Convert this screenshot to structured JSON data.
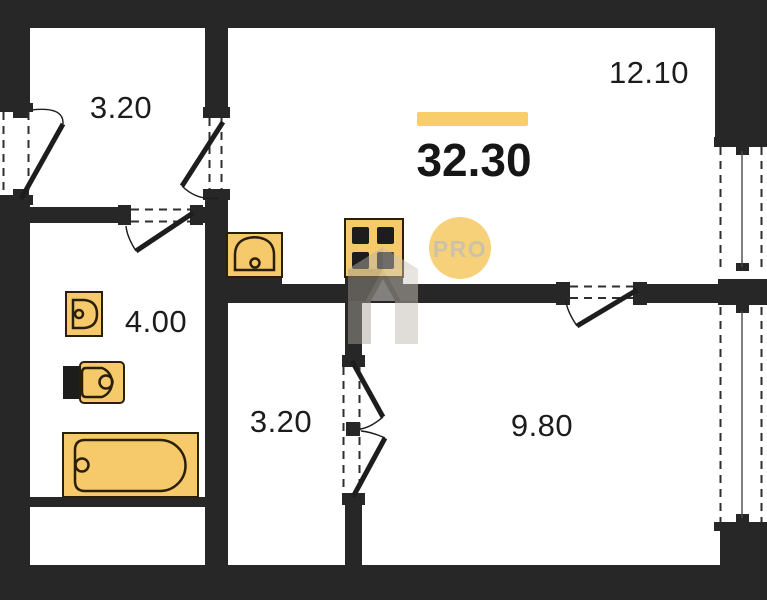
{
  "plan": {
    "title": "apartment-floor-plan",
    "total_area": "32.30",
    "badge_label": "PRO",
    "rooms": [
      {
        "id": "entrance-hall",
        "area": "3.20"
      },
      {
        "id": "living-kitchen",
        "area": "12.10"
      },
      {
        "id": "bathroom",
        "area": "4.00"
      },
      {
        "id": "corridor",
        "area": "3.20"
      },
      {
        "id": "bedroom",
        "area": "9.80"
      }
    ],
    "fixtures": [
      "kitchen-sink",
      "stove",
      "bathroom-sink",
      "toilet",
      "bathtub"
    ],
    "colors": {
      "wall": "#272727",
      "fixture_fill": "#F6CA6B",
      "fixture_outline": "#2a1f08",
      "highlight_bar": "#F8CE6B",
      "badge_background": "#F6D17A",
      "badge_text": "#cbc2a8",
      "label_text": "#1c1c1c",
      "background": "#ffffff"
    }
  }
}
